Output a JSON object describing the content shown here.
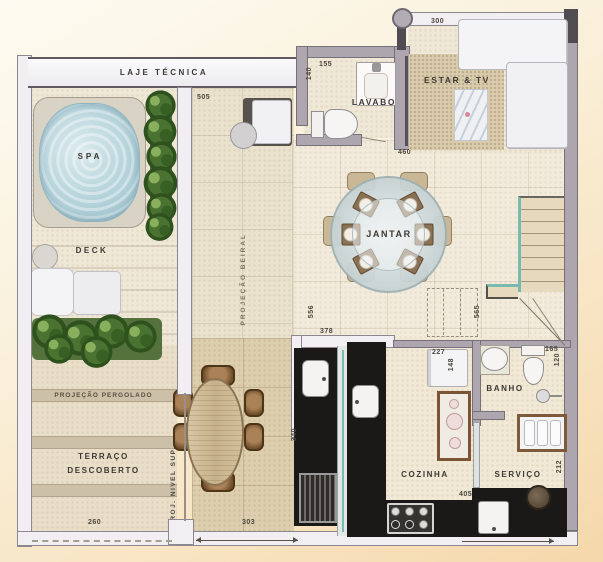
{
  "title": "penthouse-floor-plan",
  "labels": {
    "laje_tecnica": "LAJE TÉCNICA",
    "spa": "SPA",
    "deck": "DECK",
    "projecao_beiral": "PROJEÇÃO BEIRAL",
    "projecao_pergolado": "PROJEÇÃO PERGOLADO",
    "terraco_line1": "TERRAÇO",
    "terraco_line2": "DESCOBERTO",
    "proj_nivel_sup": "PROJ. NIVEL SUP.",
    "lavabo": "LAVABO",
    "estar_tv": "ESTAR & TV",
    "jantar": "JANTAR",
    "cozinha": "COZINHA",
    "banho": "BANHO",
    "servico": "SERVIÇO"
  },
  "dims": {
    "d505": "505",
    "d300": "300",
    "d155": "155",
    "d140": "140",
    "d460": "460",
    "d378": "378",
    "d556": "556",
    "d565": "565",
    "d340": "340",
    "d405": "405",
    "d260": "260",
    "d303": "303",
    "d227": "227",
    "d148": "148",
    "d165": "165",
    "d120": "120",
    "d212": "212"
  },
  "colors": {
    "wall_gray": "#aea6af",
    "counter_black": "#1b1918",
    "spa_water": "#b9d6dd",
    "plant_green": "#4a7231",
    "stair_teal": "#79b9ae",
    "floor_cream": "#f2ebdb",
    "tile_tan": "#ddcfae",
    "background_peach": "#f5d8ab"
  }
}
